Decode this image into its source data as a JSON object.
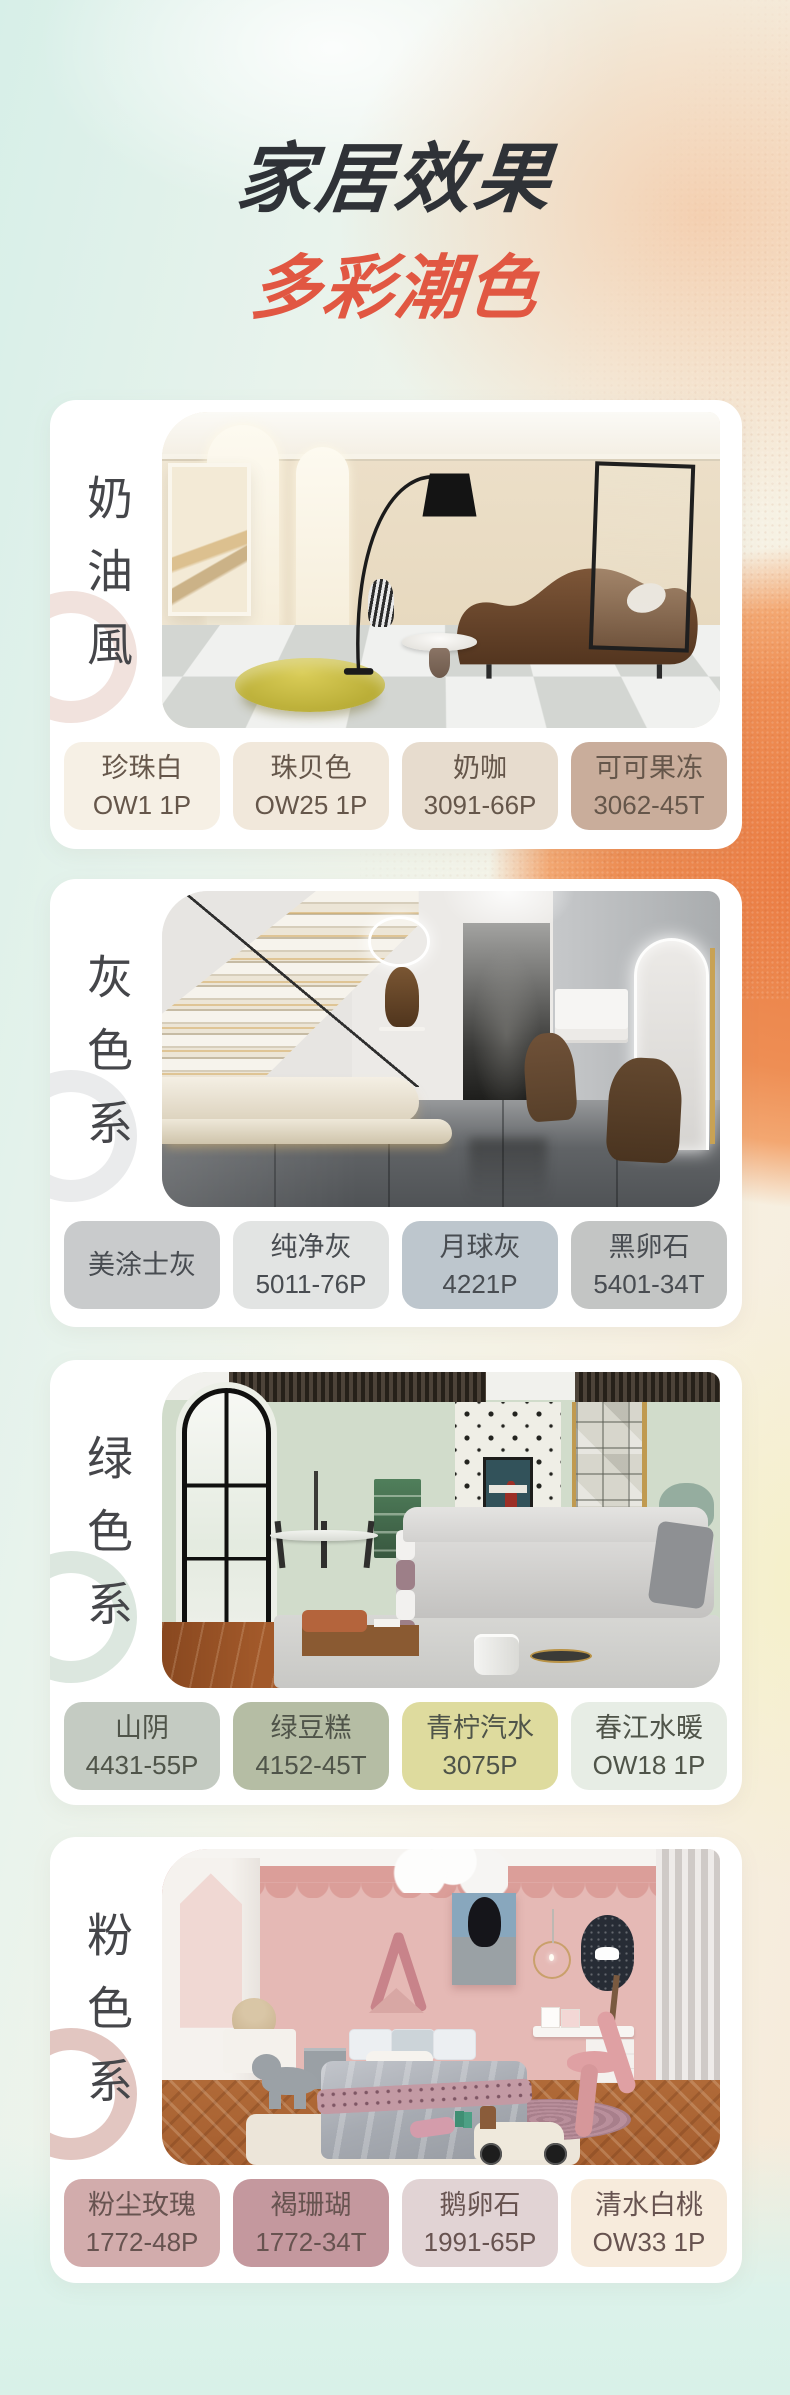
{
  "header": {
    "title": "家居效果",
    "subtitle": "多彩潮色",
    "title_color": "#2f3237",
    "subtitle_color": "#e15742"
  },
  "sections": [
    {
      "label": "奶油風",
      "photo_alt": "奶油风客厅效果图",
      "ring_color": "#f1e2dd",
      "swatches": [
        {
          "name": "珍珠白",
          "code": "OW1 1P",
          "hex": "#f6f0e5"
        },
        {
          "name": "珠贝色",
          "code": "OW25 1P",
          "hex": "#f1e8db"
        },
        {
          "name": "奶咖",
          "code": "3091-66P",
          "hex": "#e7dcce"
        },
        {
          "name": "可可果冻",
          "code": "3062-45T",
          "hex": "#c9ad9b"
        }
      ]
    },
    {
      "label": "灰色系",
      "photo_alt": "灰色系室内效果图",
      "ring_color": "#eaebec",
      "swatches": [
        {
          "name": "美涂士灰",
          "code": "",
          "hex": "#c9cbcc"
        },
        {
          "name": "纯净灰",
          "code": "5011-76P",
          "hex": "#e2e4e3"
        },
        {
          "name": "月球灰",
          "code": "4221P",
          "hex": "#bdc6cd"
        },
        {
          "name": "黑卵石",
          "code": "5401-34T",
          "hex": "#c3c5c4"
        }
      ]
    },
    {
      "label": "绿色系",
      "photo_alt": "绿色系客厅效果图",
      "ring_color": "#dce7df",
      "swatches": [
        {
          "name": "山阴",
          "code": "4431-55P",
          "hex": "#c4cbc2"
        },
        {
          "name": "绿豆糕",
          "code": "4152-45T",
          "hex": "#b5bda4"
        },
        {
          "name": "青柠汽水",
          "code": "3075P",
          "hex": "#dedb9e"
        },
        {
          "name": "春江水暖",
          "code": "OW18 1P",
          "hex": "#e7ede5"
        }
      ]
    },
    {
      "label": "粉色系",
      "photo_alt": "粉色系儿童房效果图",
      "ring_color": "#e2c6c1",
      "swatches": [
        {
          "name": "粉尘玫瑰",
          "code": "1772-48P",
          "hex": "#d2acac"
        },
        {
          "name": "褐珊瑚",
          "code": "1772-34T",
          "hex": "#c4989e"
        },
        {
          "name": "鹅卵石",
          "code": "1991-65P",
          "hex": "#e1d3d4"
        },
        {
          "name": "清水白桃",
          "code": "OW33 1P",
          "hex": "#f7ebdc"
        }
      ]
    }
  ]
}
